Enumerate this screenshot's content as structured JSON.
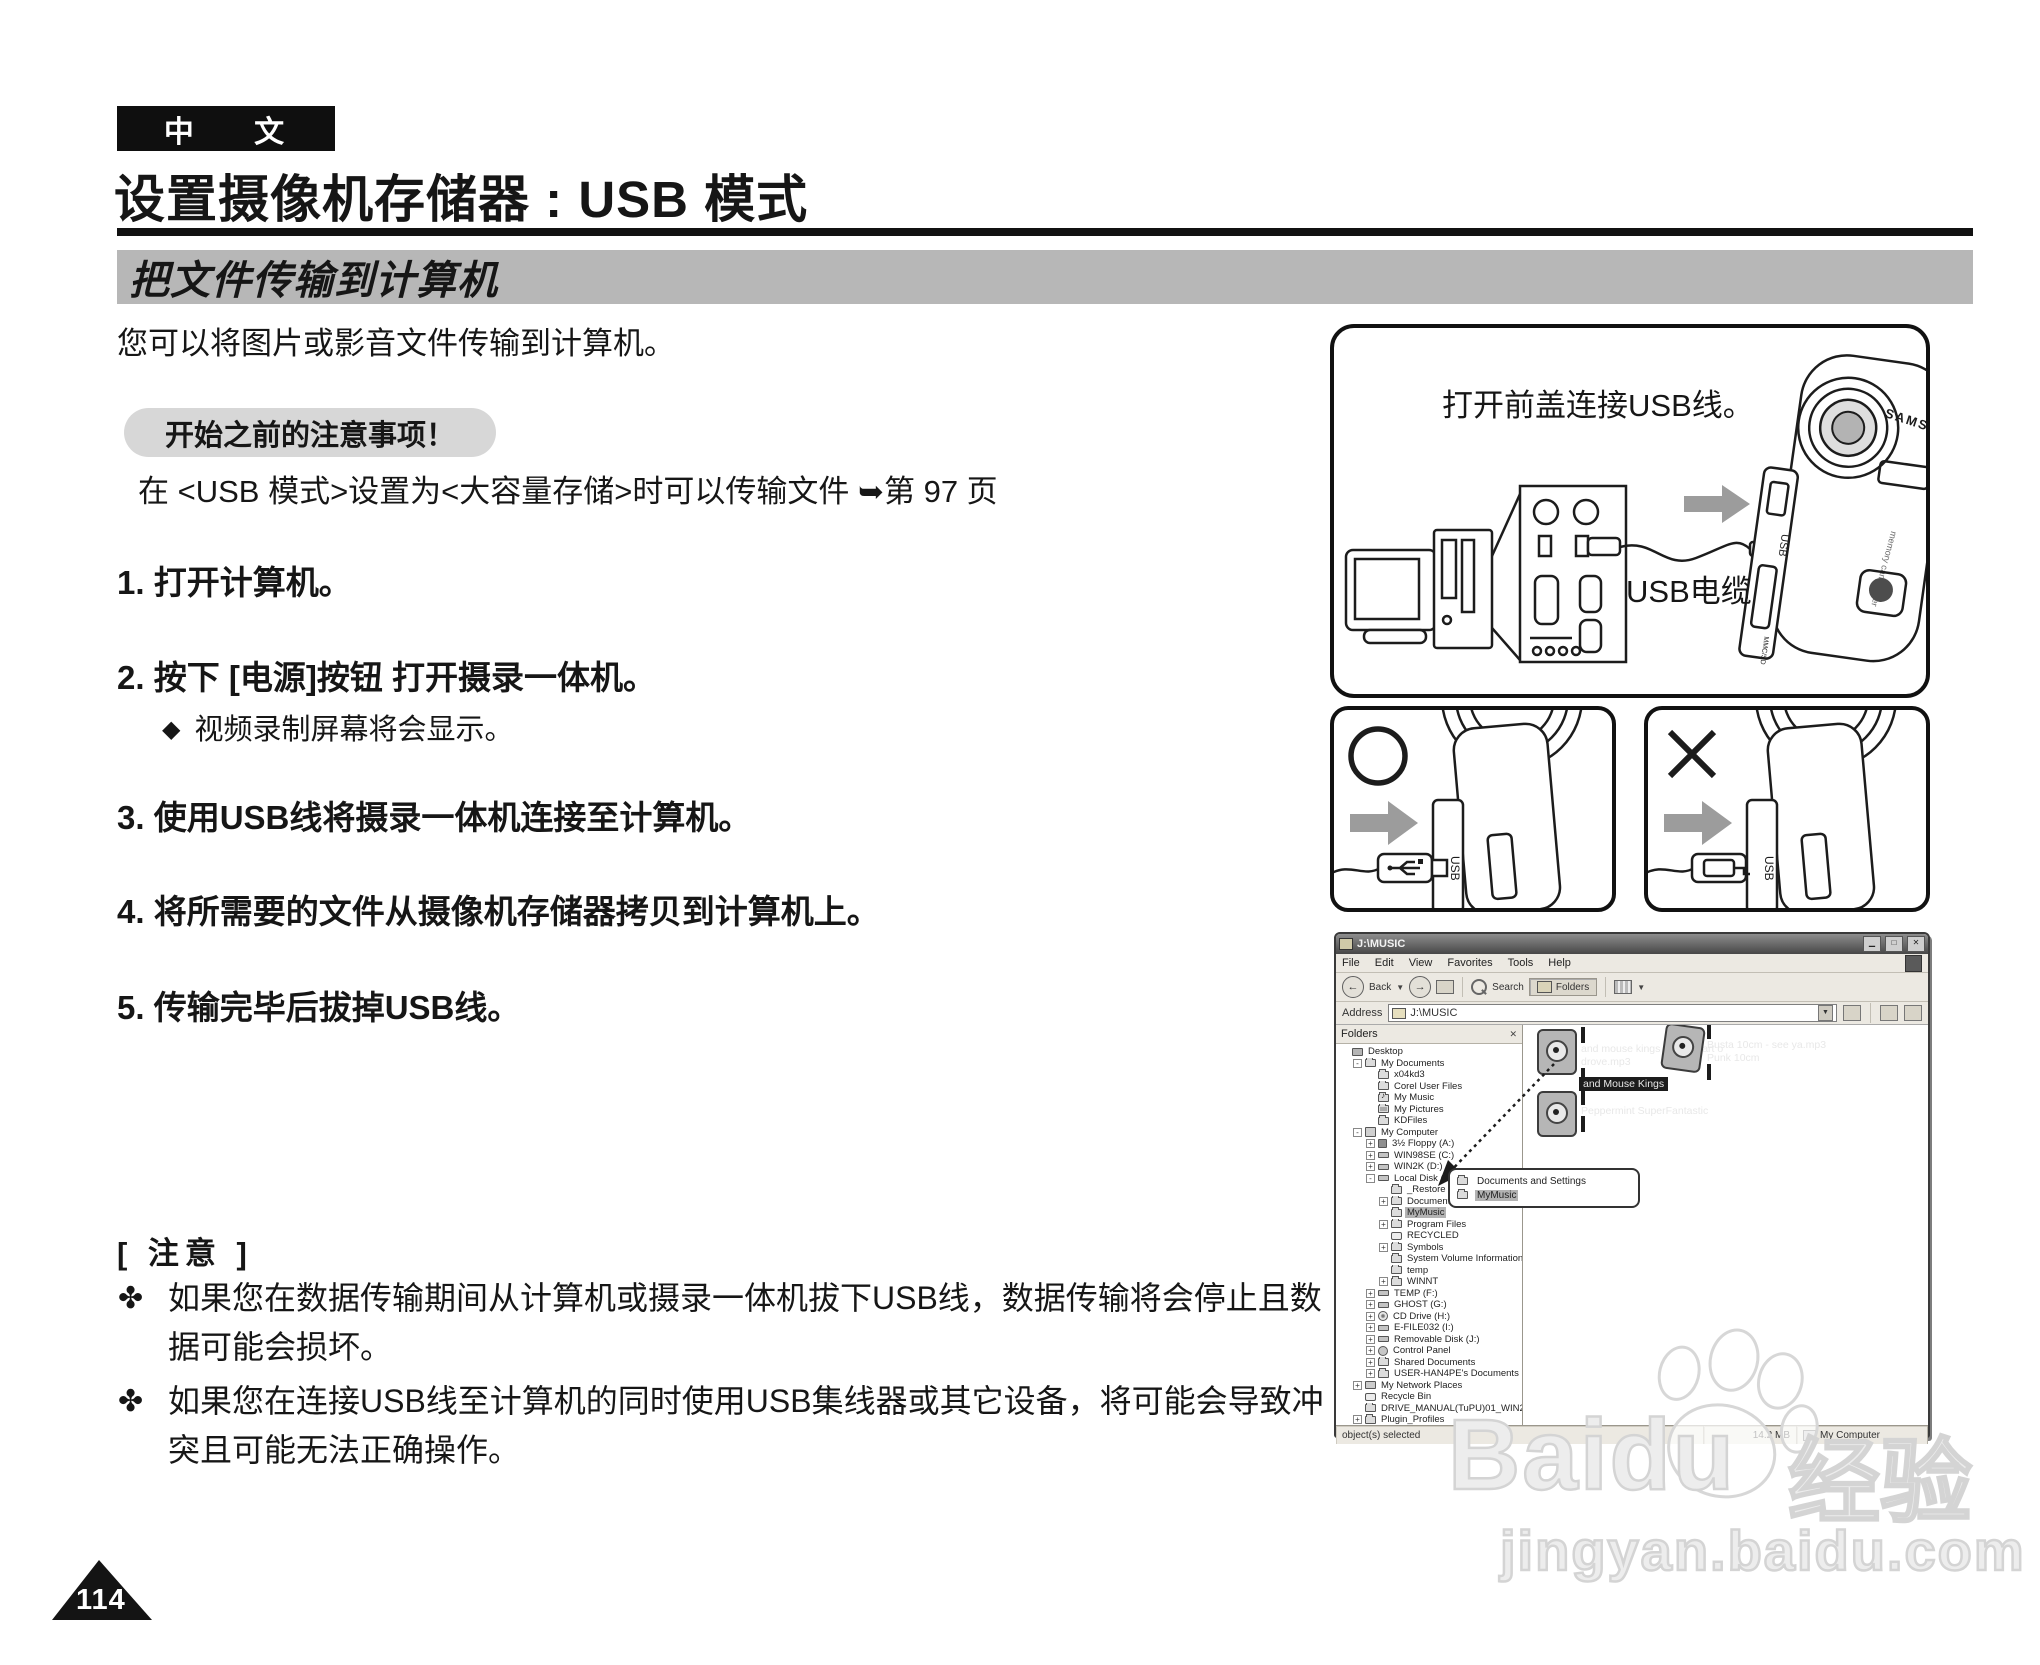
{
  "page": {
    "lang_tag": "中 文",
    "title": "设置摄像机存储器 : USB 模式",
    "section_banner": "把文件传输到计算机",
    "intro": "您可以将图片或影音文件传输到计算机。",
    "notice_label": "开始之前的注意事项！",
    "notice_text": "在 <USB 模式>设置为<大容量存储>时可以传输文件 ➥第 97 页",
    "steps": [
      "1. 打开计算机。",
      "2. 按下 [电源]按钮 打开摄录一体机。",
      "3. 使用USB线将摄录一体机连接至计算机。",
      "4. 将所需要的文件从摄像机存储器拷贝到计算机上。",
      "5. 传输完毕后拔掉USB线。"
    ],
    "step2_sub_marker": "◆",
    "step2_sub": "视频录制屏幕将会显示。",
    "note_header": "[ 注意 ]",
    "note_marker": "✤",
    "notes": [
      "如果您在数据传输期间从计算机或摄录一体机拔下USB线，数据传输将会停止且数据可能会损坏。",
      "如果您在连接USB线至计算机的同时使用USB集线器或其它设备，将可能会导致冲突且可能无法正确操作。"
    ],
    "page_number": "114"
  },
  "figure_connection": {
    "caption": "打开前盖连接USB线。",
    "cable_label": "USB电缆",
    "brand": "SAMSUNG",
    "device_label": "memory camcorder",
    "port_label": "USB",
    "slot_label": "MMC/SD"
  },
  "figure_correct": {
    "mark": "O",
    "port_label": "USB"
  },
  "figure_wrong": {
    "mark": "X",
    "port_label": "USB"
  },
  "explorer": {
    "window_title": "J:\\MUSIC",
    "menus": [
      "File",
      "Edit",
      "View",
      "Favorites",
      "Tools",
      "Help"
    ],
    "toolbar": {
      "back": "Back",
      "search": "Search",
      "folders": "Folders"
    },
    "address_label": "Address",
    "address_value": "J:\\MUSIC",
    "folders_header": "Folders",
    "tree": [
      {
        "l": 0,
        "e": "",
        "i": "desktop",
        "t": "Desktop"
      },
      {
        "l": 1,
        "e": "-",
        "i": "folder",
        "t": "My Documents"
      },
      {
        "l": 2,
        "e": "",
        "i": "folder",
        "t": "x04kd3"
      },
      {
        "l": 2,
        "e": "",
        "i": "folder",
        "t": "Corel User Files"
      },
      {
        "l": 2,
        "e": "",
        "i": "music",
        "t": "My Music"
      },
      {
        "l": 2,
        "e": "",
        "i": "pics",
        "t": "My Pictures"
      },
      {
        "l": 2,
        "e": "",
        "i": "folder",
        "t": "KDFiles"
      },
      {
        "l": 1,
        "e": "-",
        "i": "computer",
        "t": "My Computer"
      },
      {
        "l": 2,
        "e": "+",
        "i": "floppy",
        "t": "3½ Floppy (A:)"
      },
      {
        "l": 2,
        "e": "+",
        "i": "drive",
        "t": "WIN98SE (C:)"
      },
      {
        "l": 2,
        "e": "+",
        "i": "drive",
        "t": "WIN2K (D:)"
      },
      {
        "l": 2,
        "e": "-",
        "i": "drive",
        "t": "Local Disk (E:)"
      },
      {
        "l": 3,
        "e": "",
        "i": "folder",
        "t": "_Restore"
      },
      {
        "l": 3,
        "e": "+",
        "i": "folder",
        "t": "Documents and Settings"
      },
      {
        "l": 3,
        "e": "",
        "i": "folder",
        "t": "MyMusic",
        "sel": true
      },
      {
        "l": 3,
        "e": "+",
        "i": "folder",
        "t": "Program Files"
      },
      {
        "l": 3,
        "e": "",
        "i": "recycle",
        "t": "RECYCLED"
      },
      {
        "l": 3,
        "e": "+",
        "i": "folder",
        "t": "Symbols"
      },
      {
        "l": 3,
        "e": "",
        "i": "folder",
        "t": "System Volume Information"
      },
      {
        "l": 3,
        "e": "",
        "i": "folder",
        "t": "temp"
      },
      {
        "l": 3,
        "e": "+",
        "i": "folder",
        "t": "WINNT"
      },
      {
        "l": 2,
        "e": "+",
        "i": "drive",
        "t": "TEMP (F:)"
      },
      {
        "l": 2,
        "e": "+",
        "i": "drive",
        "t": "GHOST (G:)"
      },
      {
        "l": 2,
        "e": "+",
        "i": "cd",
        "t": "CD Drive (H:)"
      },
      {
        "l": 2,
        "e": "+",
        "i": "drive",
        "t": "E-FILE032 (I:)"
      },
      {
        "l": 2,
        "e": "+",
        "i": "drive",
        "t": "Removable Disk (J:)"
      },
      {
        "l": 2,
        "e": "+",
        "i": "control",
        "t": "Control Panel"
      },
      {
        "l": 2,
        "e": "+",
        "i": "folder",
        "t": "Shared Documents"
      },
      {
        "l": 2,
        "e": "+",
        "i": "folder",
        "t": "USER-HAN4PE's Documents"
      },
      {
        "l": 1,
        "e": "+",
        "i": "network",
        "t": "My Network Places"
      },
      {
        "l": 1,
        "e": "",
        "i": "recycle",
        "t": "Recycle Bin"
      },
      {
        "l": 1,
        "e": "",
        "i": "folder",
        "t": "DRIVE_MANUAL(TuPU)01_WIN2K/P"
      },
      {
        "l": 1,
        "e": "+",
        "i": "folder",
        "t": "Plugin_Profiles"
      }
    ],
    "files": [
      {
        "line1": "and mouse kings - The heart o",
        "line2": "drove.mp3",
        "line3": "and Mouse Kings"
      },
      {
        "line1": "Busta 10cm - see ya.mp3",
        "line2": "Punk 10cm"
      },
      {
        "line1": "Peppermint SuperFantastic"
      }
    ],
    "drag_tooltip": [
      "Documents and Settings",
      "MyMusic"
    ],
    "status": {
      "left": "object(s) selected",
      "size": "14.2 MB",
      "zone": "My Computer"
    }
  },
  "watermark": {
    "logo": "Baidu",
    "logo_suffix": "经验",
    "url": "jingyan.baidu.com"
  },
  "colors": {
    "banner_gray": "#b7b7b7",
    "pill_gray": "#d7d7d7",
    "arrow_gray": "#9c9c9c",
    "selection_dark": "#1c1c1c"
  }
}
